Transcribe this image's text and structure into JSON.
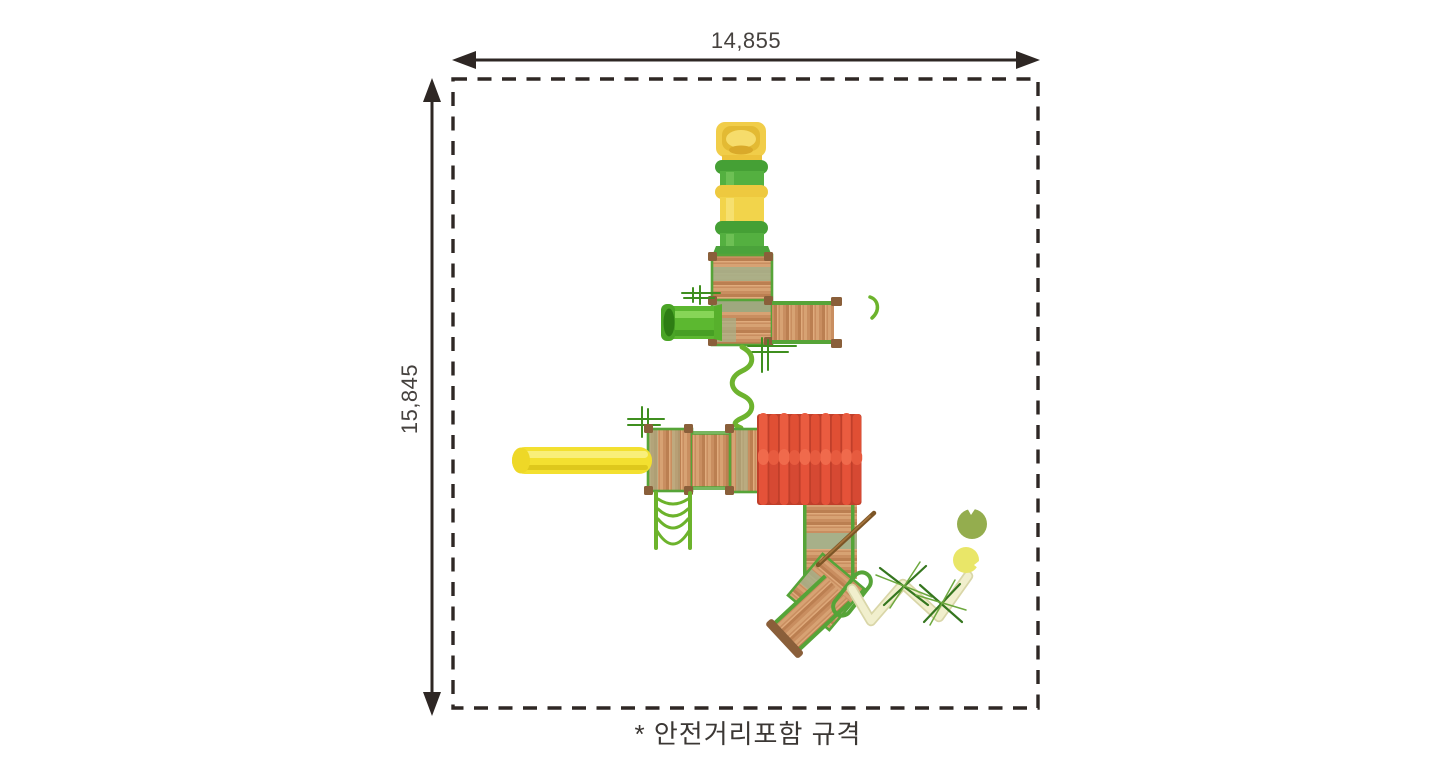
{
  "dimensions": {
    "width_label": "14,855",
    "height_label": "15,845"
  },
  "caption": "* 안전거리포함 규격",
  "icons": {
    "illustration": "playground-equipment-top-view"
  },
  "colors": {
    "line": "#2e2724",
    "text": "#45413e",
    "border_green": "#56a438",
    "tube_green": "#54ab3c",
    "slide_yellow": "#f2cf4a",
    "tube_yellow": "#f3e030",
    "roof_red": "#e04f34",
    "post_brown": "#8a5f3a",
    "beam_cream": "#f1efcd",
    "sage": "#a7b089"
  }
}
